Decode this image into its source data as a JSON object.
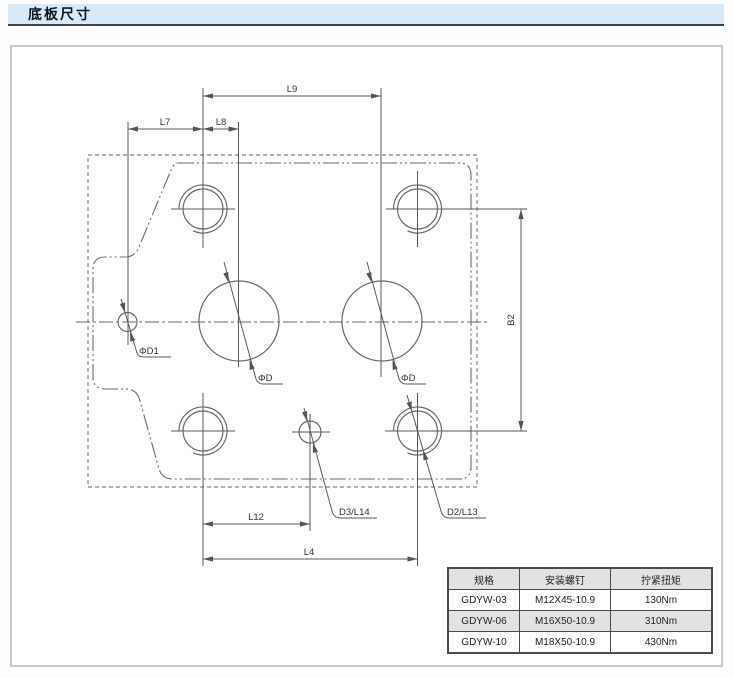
{
  "title_bar": {
    "title": "底板尺寸"
  },
  "drawing": {
    "dims": {
      "l7": "L7",
      "l8": "L8",
      "l9": "L9",
      "b2": "B2",
      "l12": "L12",
      "l4": "L4"
    },
    "leaders": {
      "d1": "ΦD1",
      "d_left": "ΦD",
      "d_right": "ΦD",
      "d3": "D3/L14",
      "d2": "D2/L13"
    }
  },
  "table": {
    "headers": [
      "规格",
      "安装螺钉",
      "拧紧扭矩"
    ],
    "rows": [
      [
        "GDYW-03",
        "M12X45-10.9",
        "130Nm"
      ],
      [
        "GDYW-06",
        "M16X50-10.9",
        "310Nm"
      ],
      [
        "GDYW-10",
        "M18X50-10.9",
        "430Nm"
      ]
    ]
  },
  "colors": {
    "title_bg": "#d8eaf7",
    "title_underline": "#39424e",
    "panel_border": "#c9c9c9",
    "drawing_line": "#6b6b6b",
    "dim_line": "#5a5a5a",
    "table_shade": "#e2e2e2"
  }
}
